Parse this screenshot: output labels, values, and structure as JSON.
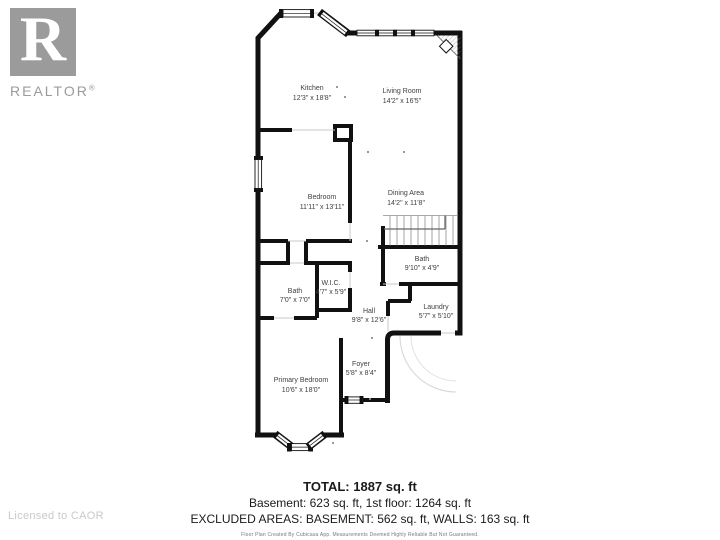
{
  "logo": {
    "letter": "R",
    "brand": "REALTOR",
    "registered": "®"
  },
  "license_text": "Licensed to CAOR",
  "floorplan": {
    "rooms": [
      {
        "name": "Kitchen",
        "dims": "12'3\" x 18'8\""
      },
      {
        "name": "Living Room",
        "dims": "14'2\" x 16'5\""
      },
      {
        "name": "Dining Area",
        "dims": "14'2\" x 11'8\""
      },
      {
        "name": "Bedroom",
        "dims": "11'11\" x 13'11\""
      },
      {
        "name": "Bath",
        "dims": "9'10\" x 4'9\""
      },
      {
        "name": "Bath",
        "dims": "7'0\" x 7'0\""
      },
      {
        "name": "W.I.C.",
        "dims": "4'7\" x 5'9\""
      },
      {
        "name": "Hall",
        "dims": "9'8\" x 12'6\""
      },
      {
        "name": "Laundry",
        "dims": "5'7\" x 5'10\""
      },
      {
        "name": "Foyer",
        "dims": "5'8\" x 8'4\""
      },
      {
        "name": "Primary Bedroom",
        "dims": "10'6\" x 18'0\""
      }
    ]
  },
  "summary": {
    "total": "TOTAL: 1887 sq. ft",
    "floors": "Basement: 623 sq. ft, 1st floor: 1264 sq. ft",
    "excluded": "EXCLUDED AREAS: BASEMENT: 562 sq. ft, WALLS: 163 sq. ft",
    "disclaimer": "Floor Plan Created By Cubicasa App. Measurements Deemed Highly Reliable But Not Guaranteed."
  },
  "colors": {
    "wall": "#111111",
    "room_label": "#404040",
    "logo_gray": "#9b9b9b",
    "license_gray": "#c9c9c9"
  }
}
